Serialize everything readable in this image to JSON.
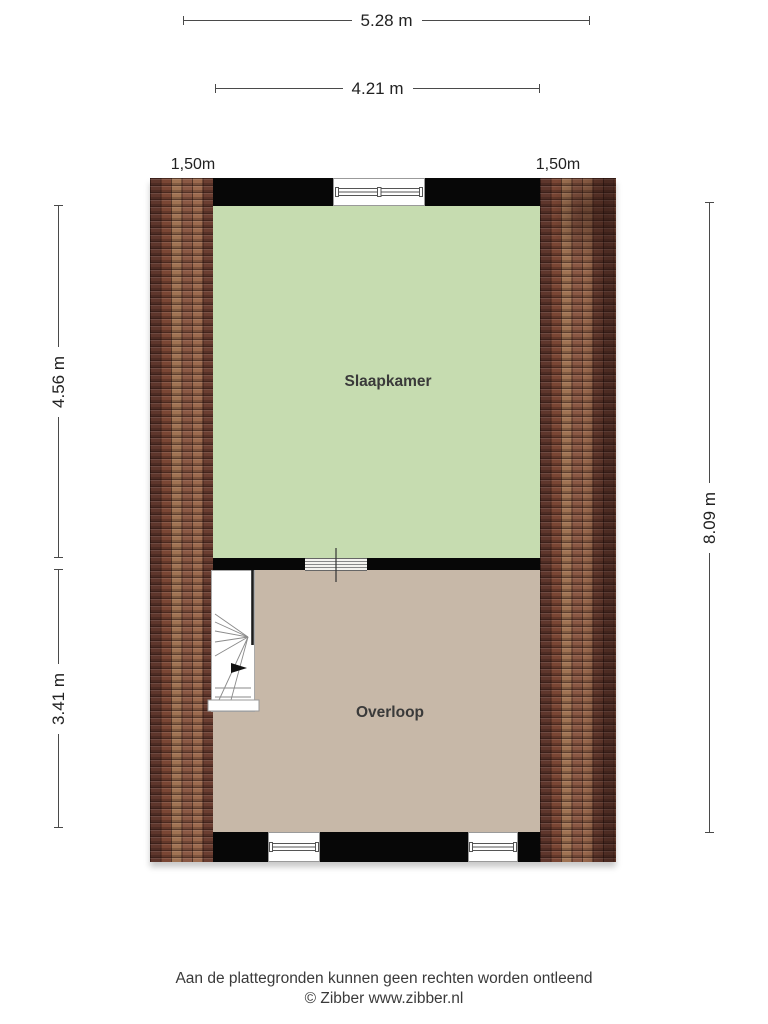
{
  "plan": {
    "type": "floorplan",
    "rooms": [
      {
        "name": "Slaapkamer"
      },
      {
        "name": "Overloop"
      }
    ],
    "features": [
      "roof-tiles-left",
      "roof-tiles-right",
      "stairs-winder",
      "window-top",
      "window-bottom-left",
      "window-bottom-right",
      "opening-middle-wall"
    ]
  },
  "dimensions": {
    "top_outer": "5.28 m",
    "top_inner": "4.21 m",
    "knee_left": "1,50m",
    "knee_right": "1,50m",
    "left_upper": "4.56 m",
    "left_lower": "3.41 m",
    "right_full": "8.09 m"
  },
  "footer": {
    "disclaimer": "Aan de plattegronden kunnen geen rechten worden ontleend",
    "copyright": "© Zibber www.zibber.nl"
  },
  "colors": {
    "room_green": "#c6dcb0",
    "room_beige": "#c7b8a8",
    "wall_black": "#070707",
    "tile_brown_dark": "#5e362c",
    "tile_brown_mid": "#8a5743",
    "tile_brown_light": "#a07353",
    "dimension_line": "#4a4a4a"
  }
}
